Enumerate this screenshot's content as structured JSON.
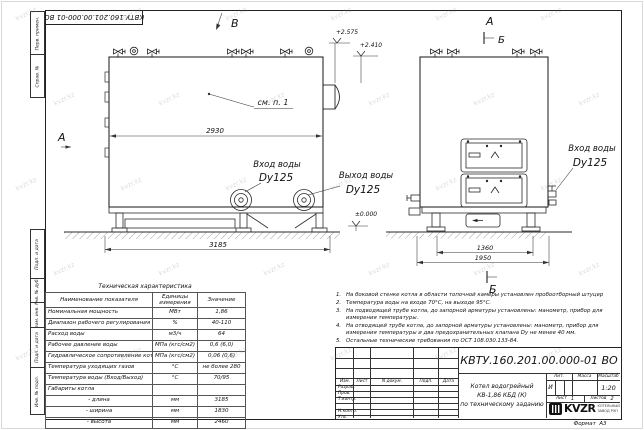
{
  "watermark": {
    "text": "kvzr.kz"
  },
  "frame_refs": {
    "doc_number_flipped": "КВТУ.160.201.00.000-01 ВО",
    "margin_top": [
      "Перв. примен.",
      "Справ. №"
    ],
    "margin_bottom": [
      "Подп. и дата",
      "Инв. № дубл.",
      "Взам. инв. №",
      "Подп. и дата",
      "Инв. № подл."
    ],
    "format_label": "Формат",
    "format_value": "А3"
  },
  "drawing": {
    "view_b": "В",
    "view_a_left": "А",
    "view_a_right": "А",
    "sec_b_top": "Б",
    "sec_b_bottom": "Б",
    "see_note": "см. п. 1",
    "dim_2930": "2930",
    "dim_3185": "3185",
    "dim_1360": "1360",
    "dim_1950": "1950",
    "elev_top": "+2.575",
    "elev_mid": "+2.410",
    "elev_zero": "±0.000",
    "main_inlet_l1": "Вход воды",
    "main_inlet_l2": "Dy125",
    "main_outlet_l1": "Выход воды",
    "main_outlet_l2": "Dy125",
    "side_inlet_l1": "Вход воды",
    "side_inlet_l2": "Dy125"
  },
  "tech_table": {
    "title": "Техническая характеристика",
    "headers": [
      "Наименование показателя",
      "Единицы измерения",
      "Значение"
    ],
    "rows": [
      [
        "Номинальная мощность",
        "МВт",
        "1,86"
      ],
      [
        "Диапазон рабочего регулирования",
        "%",
        "40-110"
      ],
      [
        "Расход воды",
        "м3/ч",
        "64"
      ],
      [
        "Рабочее давление воды",
        "МПа (кгс/см2)",
        "0,6 (6,0)"
      ],
      [
        "Гидравлическое сопротивление котла",
        "МПа (кгс/см2)",
        "0,06 (0,6)"
      ],
      [
        "Температура уходящих газов",
        "°С",
        "не более 280"
      ],
      [
        "Температура воды (Вход/Выход)",
        "°С",
        "70/95"
      ],
      [
        "Габариты котла",
        "",
        ""
      ],
      [
        "- длина",
        "мм",
        "3185"
      ],
      [
        "- ширина",
        "мм",
        "1830"
      ],
      [
        "- высота",
        "мм",
        "2460"
      ]
    ]
  },
  "notes": [
    {
      "n": "1.",
      "t": "На боковой стенке котла в области топочной камеры установлен пробоотборный штуцер"
    },
    {
      "n": "2.",
      "t": "Температура воды на входе 70°С, на выходе 95°С."
    },
    {
      "n": "3.",
      "t": "На подводящей трубе котла, до запорной арматуры установлены: манометр, прибор для измерения температуры."
    },
    {
      "n": "4.",
      "t": "На отводящей трубе котла, до запорной арматуры установлены: манометр, прибор для измерения температуры и два предохранительных клапана Dу не менее 40 мм."
    },
    {
      "n": "5.",
      "t": "Остальные технические требования по ОСТ 108.030.133-84."
    }
  ],
  "title_block": {
    "doc_number": "КВТУ.160.201.00.000-01 ВО",
    "rev_cols": [
      "Изм.",
      "Лист",
      "N докум.",
      "Подп.",
      "Дата"
    ],
    "roles": [
      "Разраб.",
      "Пров.",
      "Т.контр.",
      "",
      "Н.контр.",
      "Утв."
    ],
    "title_l1": "Котел водогрейный",
    "title_l2": "КВ-1,86 КБД (К)",
    "title_l3": "по техническому заданию",
    "lit_label": "Лит.",
    "mass_label": "Масса",
    "scale_label": "Масштаб",
    "lit_value": "И",
    "scale_value": "1:20",
    "sheet_label": "Лист",
    "sheet_value": "1",
    "sheets_label": "Листов",
    "sheets_value": "2",
    "logo_text": "KVZR",
    "logo_sub1": "КОТЕЛЬНЫЙ",
    "logo_sub2": "ЗАВОД РЭП"
  }
}
